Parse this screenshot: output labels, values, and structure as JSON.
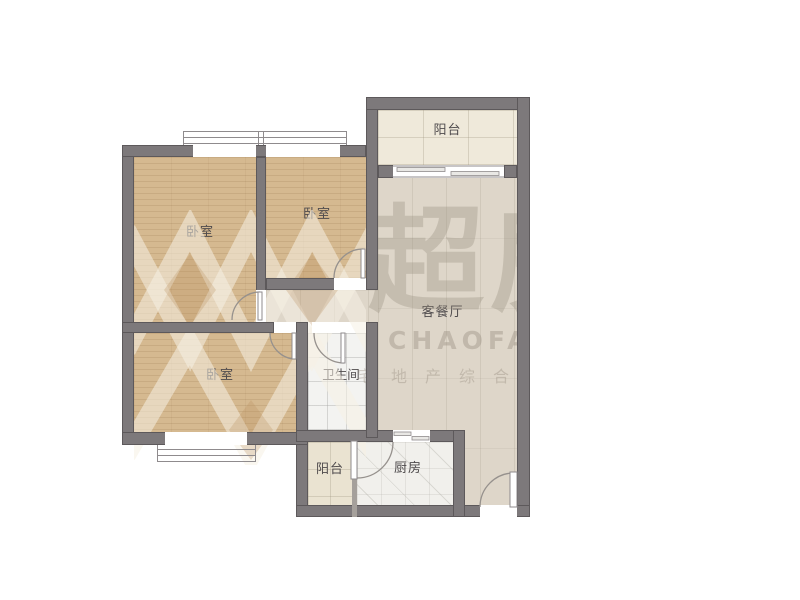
{
  "plan_title": "two-bedroom floor plan",
  "rooms": [
    {
      "id": "bedroom-top-left",
      "label": "卧室"
    },
    {
      "id": "bedroom-top-right",
      "label": "卧室"
    },
    {
      "id": "bedroom-bottom-left",
      "label": "卧室"
    },
    {
      "id": "living-dining-room",
      "label": "客餐厅"
    },
    {
      "id": "balcony-top",
      "label": "阳台"
    },
    {
      "id": "bathroom",
      "label": "卫生间"
    },
    {
      "id": "balcony-bottom",
      "label": "阳台"
    },
    {
      "id": "kitchen",
      "label": "厨房"
    }
  ],
  "watermark": {
    "brand_cn": "超房",
    "brand_latin": "CHAOFANG",
    "tagline": "宅地产综合服"
  },
  "colors": {
    "wall": "#7d797b",
    "wood": "#d5b990",
    "living": "#ded6c9",
    "balc": "#efe9da",
    "bath": "#f3f3f1",
    "kitchen": "#f1f0ec",
    "label": "#4f4b4d"
  }
}
